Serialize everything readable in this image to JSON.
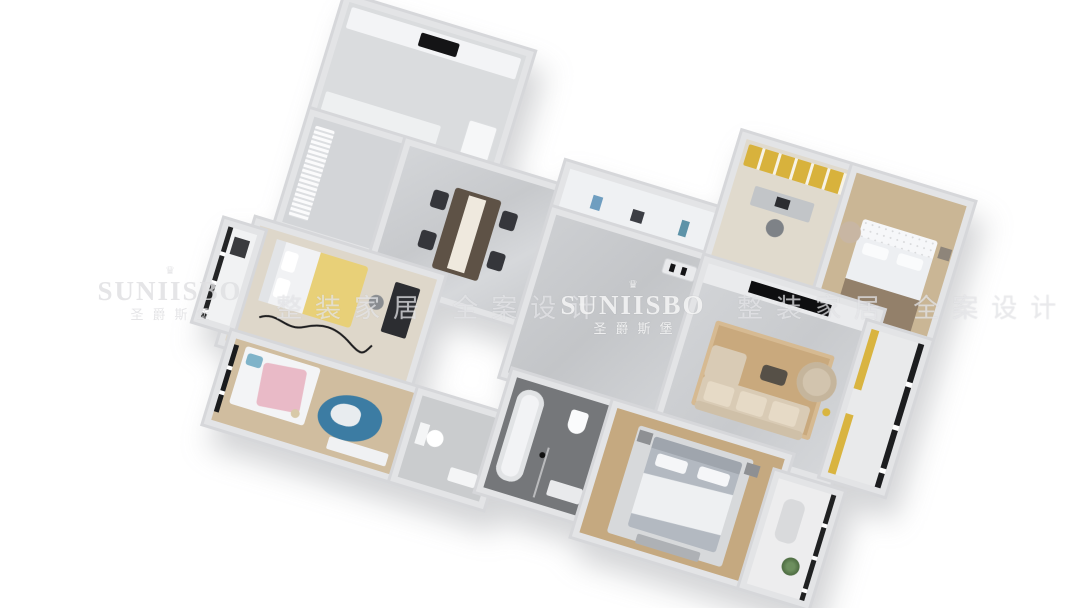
{
  "watermarks": {
    "crown": "♛",
    "brand": "SUNIISBO",
    "brand_cn": "圣爵斯堡",
    "tagline": "整装家居 全案设计"
  },
  "scene": {
    "description": "3D bird's-eye render of a four-bedroom apartment floor plan rotated on a white background",
    "rooms": [
      "kitchen",
      "entry-hall",
      "dining-room",
      "hallway-cabinets",
      "corridor",
      "study",
      "bedroom-2",
      "living-room",
      "living-balcony",
      "bedroom-1",
      "bay-window",
      "kids-bedroom",
      "bathroom-2",
      "bathroom-1",
      "master-bedroom",
      "master-balcony"
    ]
  },
  "colors": {
    "background": "#ffffff",
    "wall": "#e3e4e6",
    "marble_floor": "#cfd1d4",
    "wood_floor": "#c9b596",
    "accent_gold": "#d8b23c",
    "sofa_beige": "#d9cbb5",
    "rug_tan": "#c9a97d",
    "kids_rug_blue": "#3c7ca3",
    "pink_blanket": "#e9bac7",
    "tv_black": "#0e0e10"
  }
}
